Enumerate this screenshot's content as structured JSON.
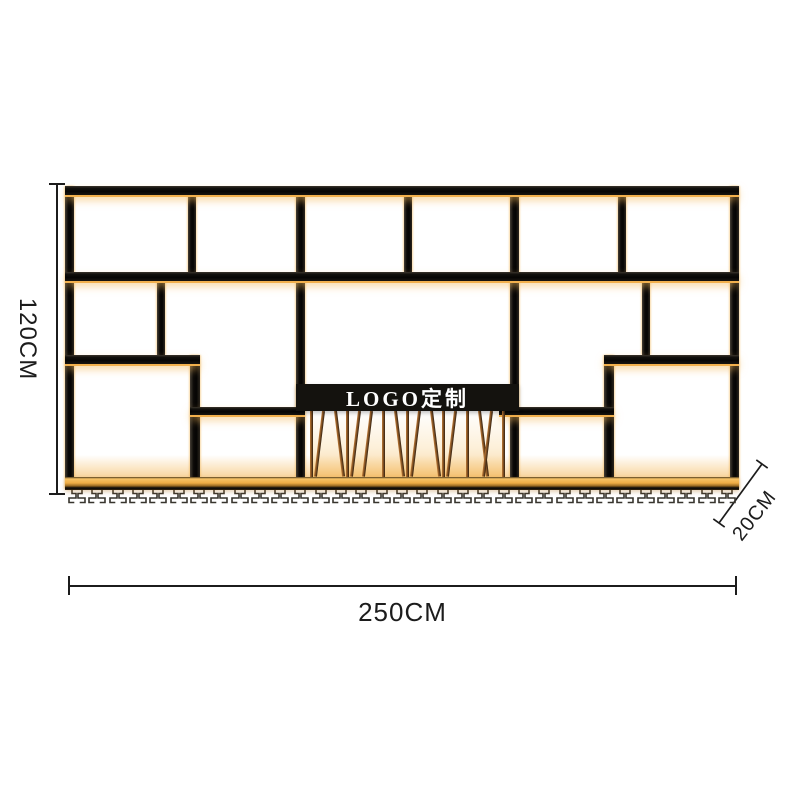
{
  "product": {
    "logo_label": "LOGO定制"
  },
  "dimensions": {
    "height": "120CM",
    "width": "250CM",
    "depth": "20CM"
  },
  "decor": {
    "bottle_rod_tilts": [
      0,
      7,
      -7,
      0,
      7,
      7,
      0,
      -7,
      0,
      7,
      -7,
      0,
      7,
      0,
      -7,
      7,
      0
    ],
    "glass_hook_pairs": 33
  },
  "colors": {
    "gold": "#f2b04d",
    "gold-bright": "#ffd98f",
    "frame": "#0b0a08",
    "band": "#14120e",
    "logo-text": "#ffffff",
    "copper": "#b5722e",
    "dim": "#1c1c1c",
    "bg": "#ffffff"
  }
}
